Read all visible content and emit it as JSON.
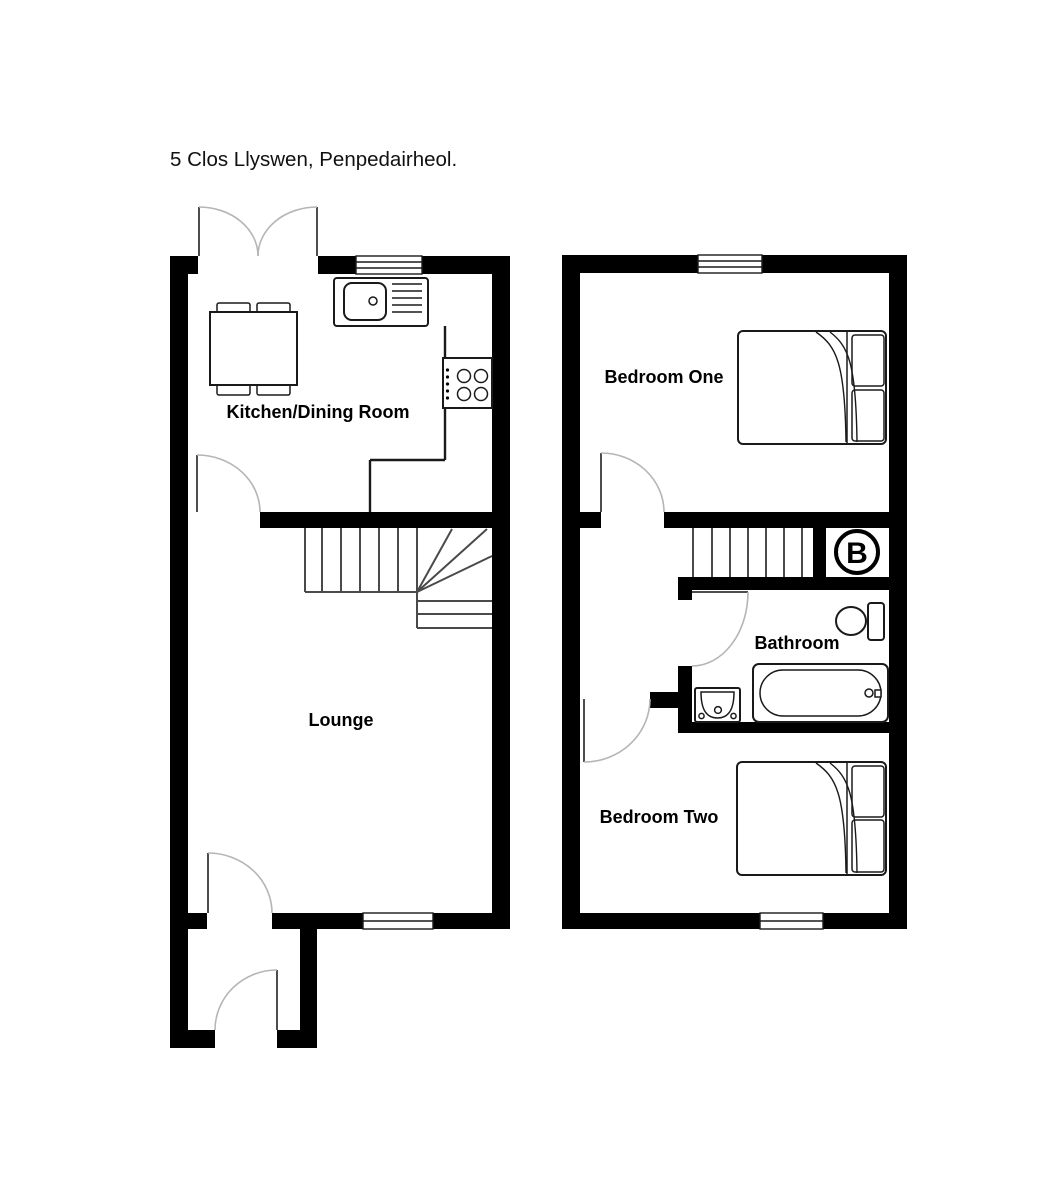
{
  "title": "5 Clos Llyswen, Penpedairheol.",
  "plans": [
    {
      "name": "ground-floor",
      "rooms": [
        {
          "label": "Kitchen/Dining Room"
        },
        {
          "label": "Lounge"
        }
      ],
      "features": [
        "french-doors",
        "window-over-sink",
        "sink-with-drainer",
        "dining-table-with-four-chairs",
        "hob",
        "staircase-with-winders",
        "kitchen-door",
        "front-door",
        "porch",
        "porch-door",
        "rear-window"
      ]
    },
    {
      "name": "first-floor",
      "rooms": [
        {
          "label": "Bedroom One"
        },
        {
          "label": "Bathroom"
        },
        {
          "label": "Bedroom Two"
        }
      ],
      "boiler": {
        "label": "B"
      },
      "features": [
        "double-bed",
        "double-bed",
        "staircase",
        "boiler-cupboard",
        "toilet",
        "wash-basin",
        "bath",
        "landing",
        "front-window",
        "rear-window"
      ]
    }
  ],
  "colors": {
    "wall": "#000000",
    "background": "#ffffff",
    "fixture_line": "#1a1a1a",
    "stair_line": "#4a4a4a",
    "door_arc": "#b5b5b5",
    "door_leaf": "#4d4d4d",
    "label": "#000000"
  }
}
